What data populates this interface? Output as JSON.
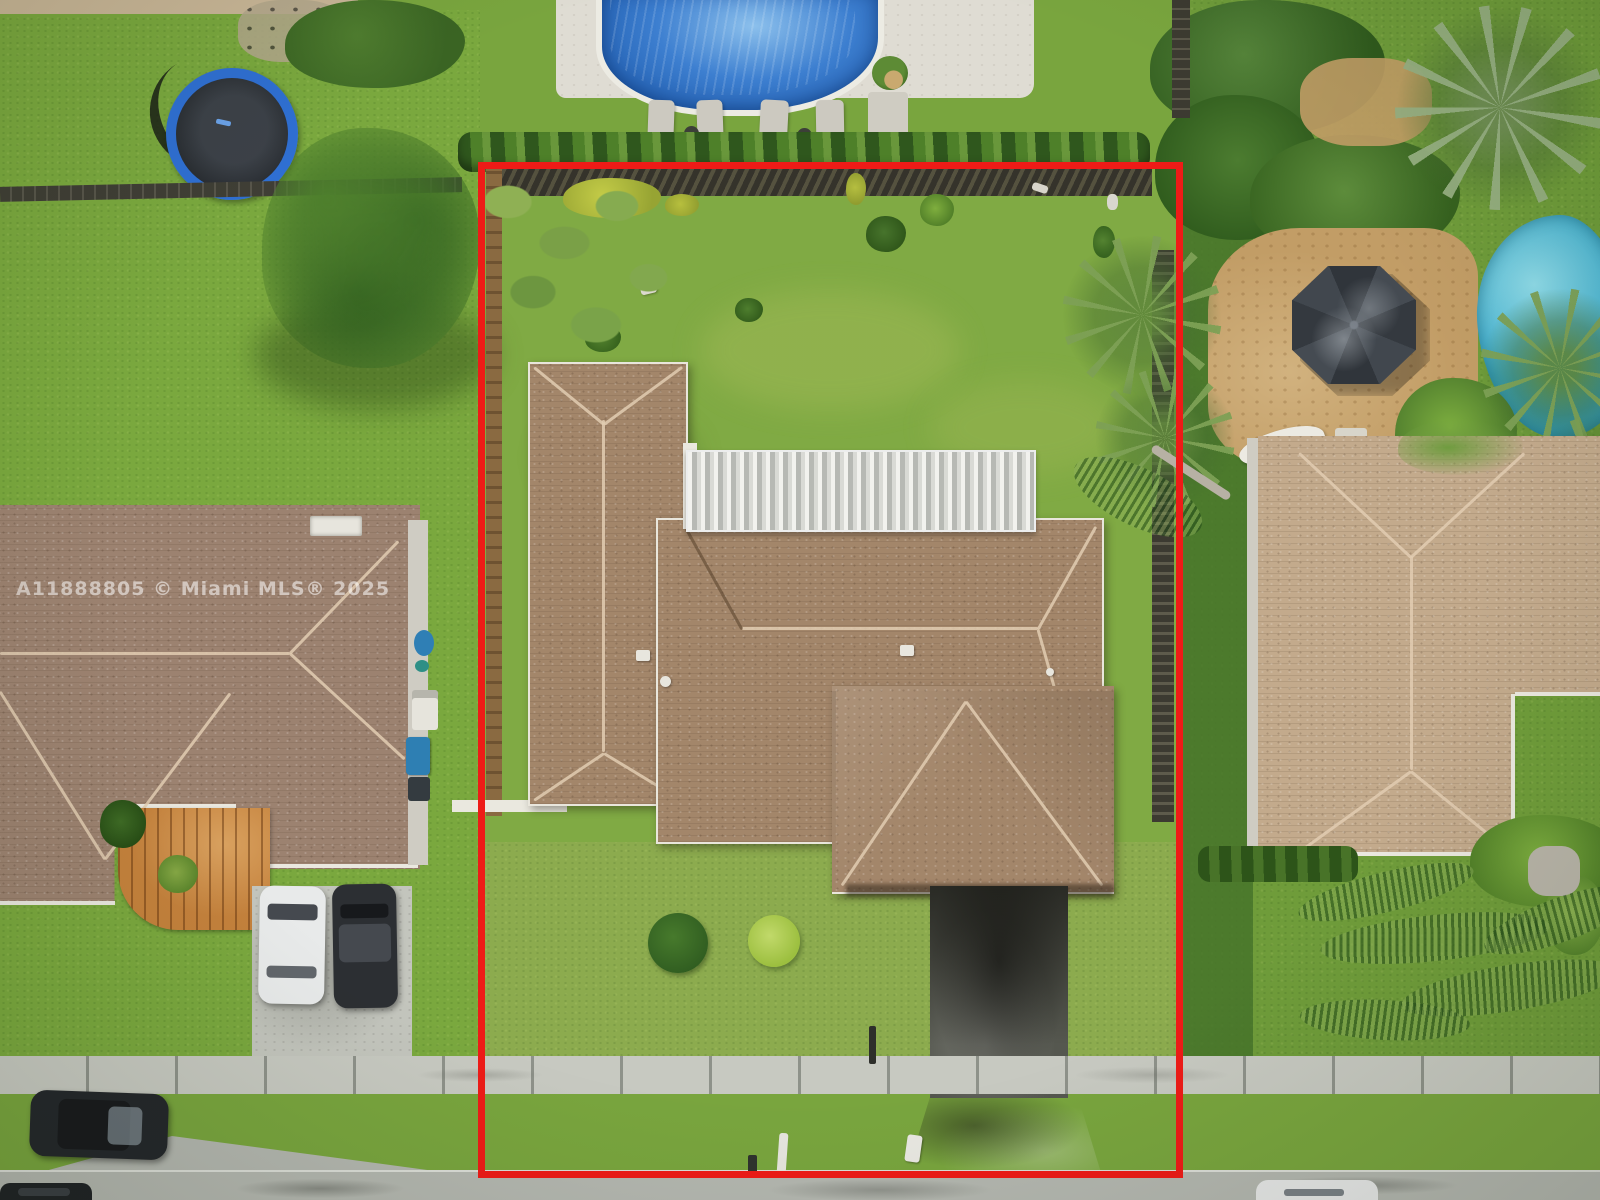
{
  "watermark": {
    "text": "A11888805 © Miami MLS® 2025"
  },
  "boundary": {
    "label": "red property boundary outline"
  },
  "scene": {
    "type": "aerial-drone-photo",
    "description": "Top-down aerial photo of a suburban single-family home lot outlined in red, with large grassy backyard, brown shingle roof, white patio cover, dark stained driveway, neighboring houses with pools, a trampoline, gazebo, parked cars, sidewalk and street.",
    "objects": [
      "property boundary outline",
      "main house shingle roof",
      "white corrugated patio cover",
      "backyard lawn",
      "wood privacy fences",
      "front yard bushes",
      "dark stained driveway",
      "sidewalk",
      "street",
      "mailbox",
      "left neighbor house",
      "left neighbor walkway",
      "parked white car",
      "parked dark car",
      "suv parked on grass",
      "trash bins",
      "top neighbor swimming pool",
      "pool deck lounge chairs",
      "trampoline",
      "right neighbor house",
      "gazebo",
      "right neighbor pool",
      "travertine patio",
      "palm trees",
      "fallen palm fronds",
      "hedges and shrubs"
    ]
  },
  "colors": {
    "boundary-red": "#ee1b17",
    "roof-main": "#a3866a",
    "roof-left": "#9c8270",
    "roof-right": "#c3aa8c",
    "roof-ridge": "#e2cdb2",
    "patio-cover": "#e8e9e5",
    "lawn-base": "#79a53e",
    "lawn-front": "#8cab4e",
    "lawn-left": "#7aa83e",
    "lawn-right": "#6f9c3a",
    "lawn-dark-strip": "#47742a",
    "hedge": "#3c661f",
    "pool-blue": "#2e6fc2",
    "pool-teal": "#3aabcc",
    "deck": "#dfdcd3",
    "travertine": "#c29d66",
    "gazebo": "#3a3f46",
    "fence-dark": "#45433a",
    "fence-brown": "#8a6a41",
    "sidewalk": "#c7c9c1",
    "street": "#b4b7b0",
    "driveway-dark": "#55574f",
    "concrete": "#c3c5bd",
    "walkway-orange": "#c4813c",
    "watermark": "#ffffff"
  }
}
